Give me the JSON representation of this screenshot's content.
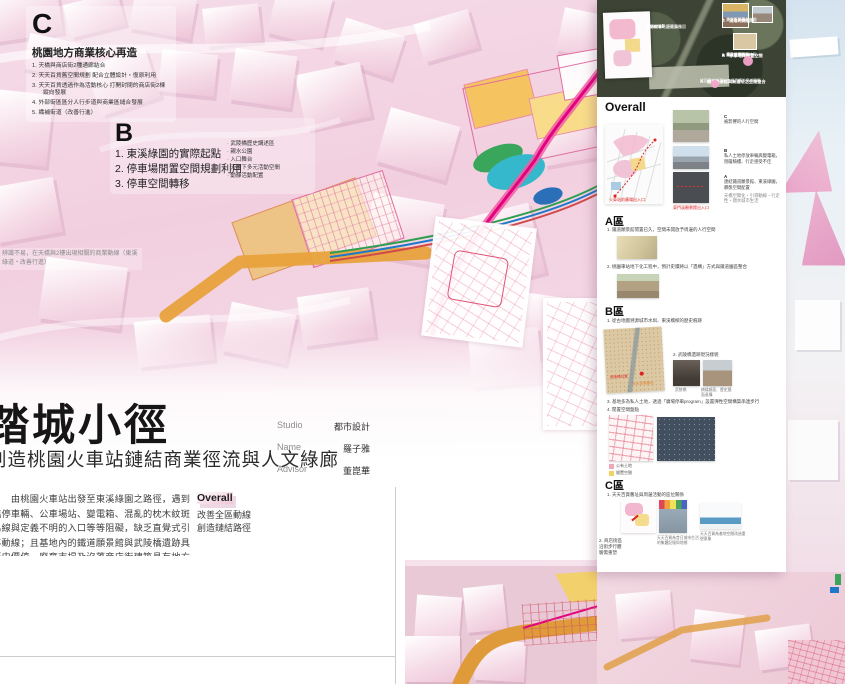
{
  "colors": {
    "accent_magenta": "#e4007f",
    "orange": "#e8a23c",
    "yellow": "#f2d165",
    "teal": "#35b8cb",
    "green": "#2e9e4f",
    "blue": "#1f78c8",
    "pink_land": "#f0a7b8"
  },
  "section_c": {
    "letter": "C",
    "title": "桃園地方商業核心再造",
    "items": [
      "1. 天橋與商店街2種通廊結合",
      "2. 天天百貨舊空間規劃 配合立體設計・復原利用",
      "3. 天天百貨透過作為活動核心 打開封閉的商店街2棟縱向發展",
      "4. 外部街區區分人行步道與商業區縫合發展",
      "5. 織補街道（改善行進）"
    ]
  },
  "section_b": {
    "letter": "B",
    "items": [
      "1. 東溪綠園的實際起點",
      "2. 停車場閒置空間規劃利用",
      "3. 停車空間轉移"
    ],
    "sub_items": [
      "武陵橋歷史講述區",
      "親水公園",
      "入口舞台",
      "天橋下多元活動空間",
      "動靜活動配置"
    ]
  },
  "margin_note": "辨識不易，在天橋與2樓出現相關的商業動線（東溪綠道・改善行進）",
  "title_block": {
    "title": "踏城小徑",
    "subtitle": "創造桃園火車站鏈結商業徑流與人文綠廊",
    "studio_label": "Studio",
    "studio": "都市設計",
    "name_label": "Name",
    "name": "羅子雅",
    "advisor_label": "Advisor",
    "advisor": "董崑華"
  },
  "intro": {
    "paragraph": "　　由桃園火車站出發至東溪綠園之路徑，遇到臨停車輛、公車場站、變電箱、混亂的枕木紋斑馬線與定義不明的入口等等阻礙，缺乏直覺式引導動線；且基地內的鐵道願景館與武陵橋遺跡具歷史價值，廢棄市場及沒落商店街建築具有地方創生產業發展潛力。因此本案藉由規劃地面層與天橋層動線重新鏈結東溪綠園與火車站，並將三區基地分別定義為三種不同的城市生活舞台：",
    "overall_title": "Overall",
    "overall_line1": "改善全區動線",
    "overall_line2": "創造鏈結路徑",
    "zone_a_title": "A區｜歷史舞台",
    "zone_a_desc": "鐵道願景館與新遺址空間整合",
    "zone_b_title": "B區｜水文舞台",
    "zone_b_desc": "重新演繹東門溪與武陵橋創造現代意義",
    "zone_c_title": "C區｜地方創生商業核心",
    "zone_c_desc": "空間再生與地方青創能量導入"
  },
  "panel": {
    "satellite": {
      "overlay_title": "Overall",
      "overlay_line1": "桃園火車站至東溪綠園",
      "overlay_line2": "步行體驗・鏈結舞台",
      "callout_c_title": "C　沒落的商店街",
      "callout_c_1": "1. 天天百貨舊址",
      "callout_c_2": "2. 商店街與騎樓空間",
      "callout_b_title": "B　停車場與閒置空間",
      "callout_b_1": "1. 東溪綠園的入口",
      "callout_b_2": "2. 武陵橋遺跡鏈結區",
      "callout_b_3": "3. 親水空間活動",
      "callout_b_4": "4. 停車空間轉移",
      "callout_a_title": "A　鐵道願景館與新遺址之空間整合",
      "callout_a_sub": "桃園車站地下化工程遺構與鐵道園區"
    },
    "overall": {
      "heading": "Overall",
      "cap_c_letter": "C",
      "cap_c": "被影響的人行空間",
      "cap_b_letter": "B",
      "cap_b": "私人土地停放車輛與變電箱，阻礙騎樓、行走感受不佳",
      "cap_a_letter": "A",
      "cap_a": "連結鐵道願景館、東溪綠園，靜態空間配置",
      "cap_a_sub": "天橋空間化・引導動線・行走性・親水城市生活",
      "map_label_left": "火車站前廣場出入口",
      "map_label_right": "東門溪願景館出入口"
    },
    "zone_a": {
      "heading": "A區",
      "item1": "1. 鐵道願景館閒置已久，空間未開放予周邊的人行空間",
      "item2": "2. 桃園車站地下化工程中，預計史蹟將以「遺構」方式與鐵道園區整合"
    },
    "zone_b": {
      "heading": "B區",
      "item1": "1. 從古地圖溯源城市水圳、東溪橋樑的歷史痕跡",
      "item2": "2. 武陵橋遺跡現況樣貌",
      "cap1": "武陵橋",
      "cap2": "橋樑斷面、歷史牆面遺構",
      "item3": "3. 基地多為私人土地，透過「廣場停車program」設置彈性空間構築串連步行",
      "item4": "4. 閒置空間盤點",
      "map_label_red": "武陵橋位置",
      "map_label_orange": "天天百貨舊址",
      "legend1": "公有土地",
      "legend2": "閒置空間"
    },
    "zone_c": {
      "heading": "C區",
      "item1": "1. 天天百貨舊址與周邊活動的區位關係",
      "item2": "2. 商店街區沿街步行體驗需重塑",
      "cap1": "天天百貨為昔日城市生活的集體記憶與地標",
      "cap2": "天天百貨為基地空間改造重塑意象"
    }
  }
}
